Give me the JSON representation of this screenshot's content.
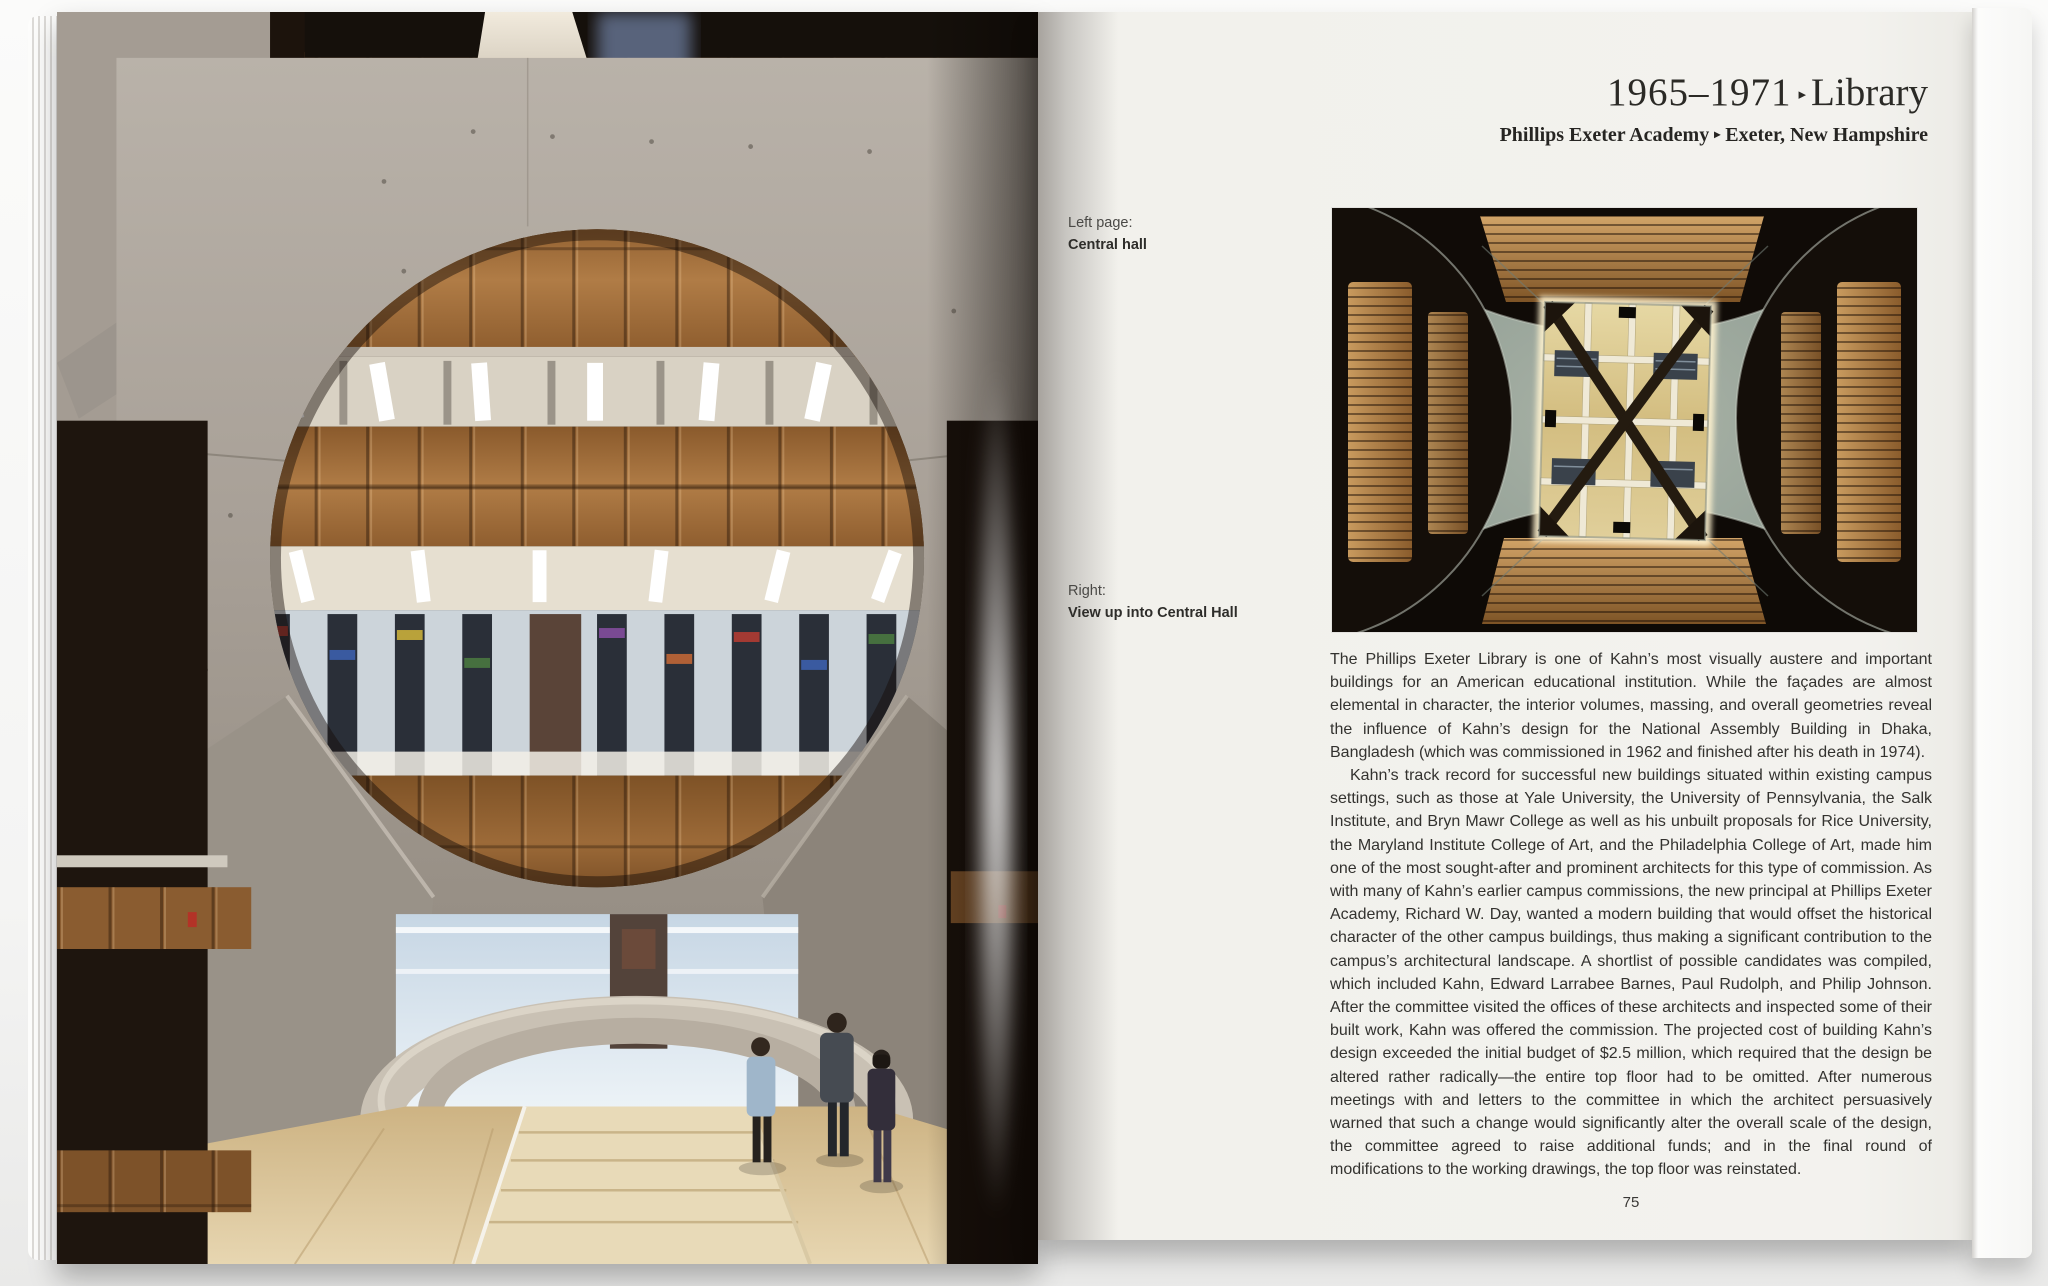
{
  "title": {
    "years": "1965–1971",
    "arrow": "▸",
    "name": "Library"
  },
  "subtitle": {
    "part1": "Phillips Exeter Academy",
    "arrow": "▸",
    "part2": "Exeter, New Hampshire"
  },
  "captions": [
    {
      "label": "Left page:",
      "text": "Central hall"
    },
    {
      "label": "Right:",
      "text": "View up into Central Hall"
    }
  ],
  "article": {
    "paragraphs": [
      "The Phillips Exeter Library is one of Kahn’s most visually austere and important buildings for an American educational institution. While the façades are almost elemental in character, the interior volumes, massing, and overall geometries reveal the influence of Kahn’s design for the National Assembly Building in Dhaka, Bangladesh (which was commissioned in 1962 and finished after his death in 1974).",
      "Kahn’s track record for successful new buildings situated within existing campus settings, such as those at Yale University, the University of Pennsylvania, the Salk Institute, and Bryn Mawr College as well as his unbuilt proposals for Rice University, the Maryland Institute College of Art, and the Philadelphia College of Art, made him one of the most sought-after and prominent architects for this type of commission. As with many of Kahn’s earlier campus commissions, the new principal at Phillips Exeter Academy, Richard W. Day, wanted a modern building that would offset the historical character of the other campus buildings, thus making a significant contribution to the campus’s architectural landscape. A shortlist of possible candidates was compiled, which included Kahn, Edward Larrabee Barnes, Paul Rudolph, and Philip Johnson. After the committee visited the offices of these architects and inspected some of their built work, Kahn was offered the commission. The projected cost of building Kahn’s design exceeded the initial budget of $2.5 million, which required that the design be altered rather radically—the entire top floor had to be omitted. After numerous meetings with and letters to the committee in which the architect persuasively warned that such a change would significantly alter the overall scale of the design, the committee agreed to raise additional funds; and in the final round of modifications to the working drawings, the top floor was reinstated."
    ]
  },
  "page_number": "75",
  "palette": {
    "paper": "#f3f2ee",
    "title_ink": "#2b2a26",
    "body_ink": "#33322f",
    "concrete": "#a49c93",
    "wood": "#a5703c",
    "skylight_glow": "#efe3b5",
    "dark_void": "#140e09"
  }
}
